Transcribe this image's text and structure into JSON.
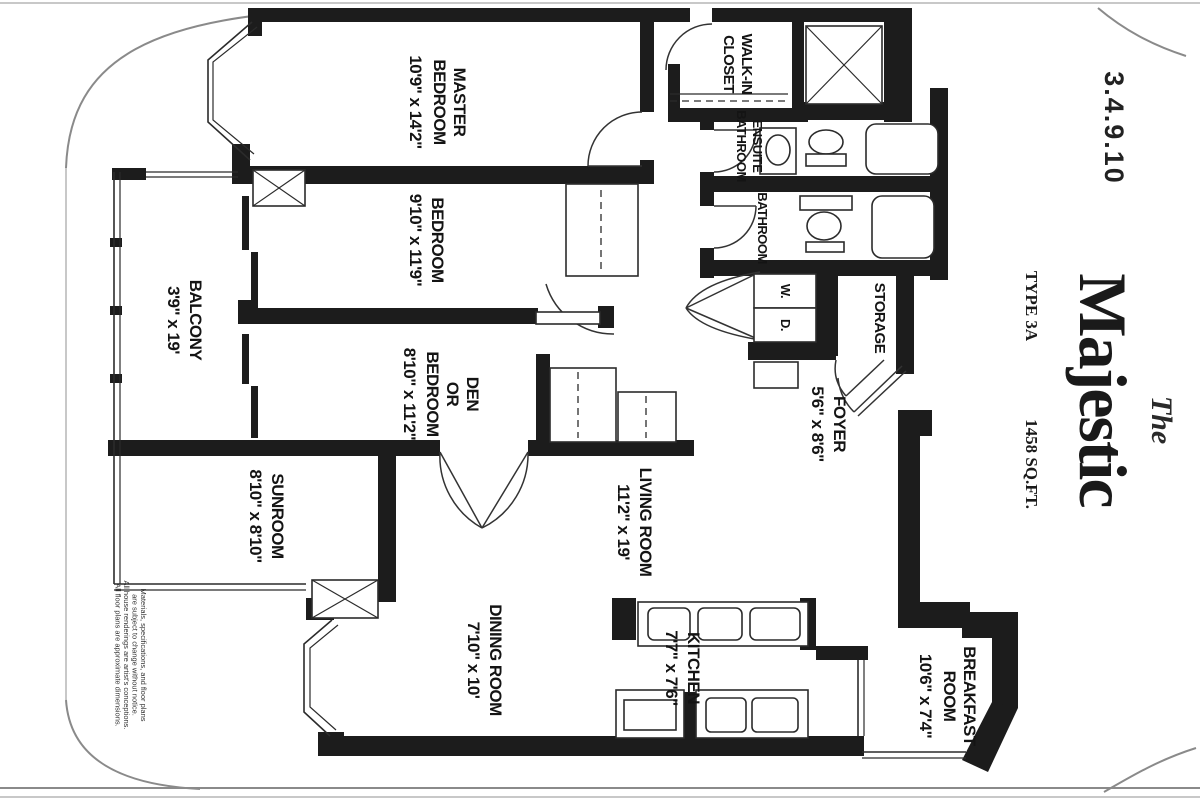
{
  "title": {
    "unit_numbers": "3.4.9.10",
    "the": "The",
    "name": "Majestic",
    "type": "TYPE 3A",
    "area": "1458 SQ.FT."
  },
  "rooms": [
    {
      "name": "MASTER BEDROOM",
      "lines": [
        "MASTER",
        "BEDROOM"
      ],
      "dims": "10'9\" x 14'2\""
    },
    {
      "name": "BEDROOM",
      "lines": [
        "BEDROOM"
      ],
      "dims": "9'10\" x 11'9\""
    },
    {
      "name": "DEN OR BEDROOM",
      "lines": [
        "DEN",
        "OR",
        "BEDROOM"
      ],
      "dims": "8'10\" x 11'2\""
    },
    {
      "name": "BALCONY",
      "lines": [
        "BALCONY"
      ],
      "dims": "3'9\" x 19'"
    },
    {
      "name": "SUNROOM",
      "lines": [
        "SUNROOM"
      ],
      "dims": "8'10\" x 8'10\""
    },
    {
      "name": "LIVING ROOM",
      "lines": [
        "LIVING ROOM"
      ],
      "dims": "11'2\" x 19'"
    },
    {
      "name": "DINING ROOM",
      "lines": [
        "DINING ROOM"
      ],
      "dims": "7'10\" x 10'"
    },
    {
      "name": "KITCHEN",
      "lines": [
        "KITCHEN"
      ],
      "dims": "7'7\" x 7'6\""
    },
    {
      "name": "BREAKFAST ROOM",
      "lines": [
        "BREAKFAST",
        "ROOM"
      ],
      "dims": "10'6\" x 7'4\""
    },
    {
      "name": "FOYER",
      "lines": [
        "FOYER"
      ],
      "dims": "5'6\" x 8'6\""
    },
    {
      "name": "STORAGE",
      "lines": [
        "STORAGE"
      ]
    },
    {
      "name": "WALK-IN CLOSET",
      "lines": [
        "WALK-IN",
        "CLOSET"
      ]
    },
    {
      "name": "ENSUITE BATHROOM",
      "lines": [
        "ENSUITE",
        "BATHROOM"
      ]
    },
    {
      "name": "BATHROOM",
      "lines": [
        "BATHROOM"
      ]
    }
  ],
  "appliances": {
    "washer": "W.",
    "dryer": "D."
  },
  "disclaimer": {
    "lines": [
      "Materials, specifications, and floor plans",
      "are subject to change without notice.",
      "All house renderings are artist's conceptions.",
      "All floor plans are approximate dimensions."
    ]
  },
  "colors": {
    "ink": "#1c1c1c",
    "paper": "#ffffff"
  }
}
